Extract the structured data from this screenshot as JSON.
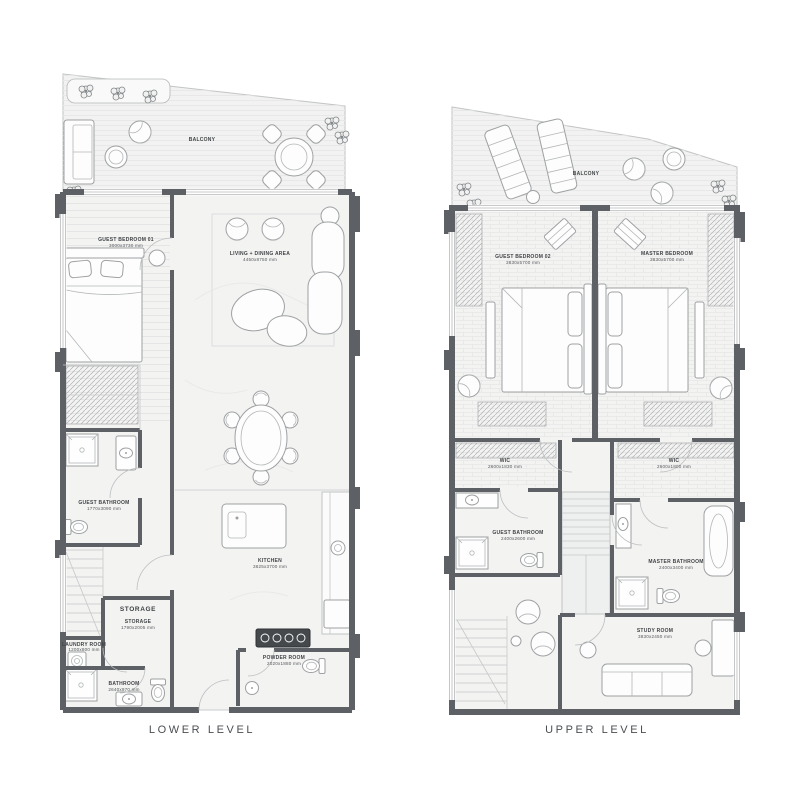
{
  "colors": {
    "wall": "#5d6165",
    "floor": "#f3f3f2",
    "balcony_floor": "#f1f2f1",
    "text": "#404346",
    "background": "#ffffff"
  },
  "lower": {
    "title": "LOWER LEVEL",
    "balcony": "BALCONY",
    "storage_heading": "STORAGE",
    "rooms": {
      "guest_bedroom": {
        "name": "GUEST BEDROOM 01",
        "dims": "3000x3730 mm"
      },
      "living_dining": {
        "name": "LIVING + DINING AREA",
        "dims": "4450x8750 mm"
      },
      "guest_bathroom": {
        "name": "GUEST BATHROOM",
        "dims": "1770x3090 mm"
      },
      "kitchen": {
        "name": "KITCHEN",
        "dims": "3625x3700 mm"
      },
      "storage": {
        "name": "STORAGE",
        "dims": "1790x2005 mm"
      },
      "laundry": {
        "name": "LAUNDRY ROOM",
        "dims": "1200x800 mm"
      },
      "bathroom": {
        "name": "BATHROOM",
        "dims": "2640x970 mm"
      },
      "powder": {
        "name": "POWDER ROOM",
        "dims": "2020x1880 mm"
      }
    }
  },
  "upper": {
    "title": "UPPER LEVEL",
    "balcony": "BALCONY",
    "rooms": {
      "guest_bedroom": {
        "name": "GUEST BEDROOM 02",
        "dims": "3830x5700 mm"
      },
      "master_bedroom": {
        "name": "MASTER BEDROOM",
        "dims": "3830x5700 mm"
      },
      "wic_left": {
        "name": "WIC",
        "dims": "2600x1830 mm"
      },
      "wic_right": {
        "name": "WIC",
        "dims": "2600x1800 mm"
      },
      "guest_bathroom": {
        "name": "GUEST BATHROOM",
        "dims": "2400x2600 mm"
      },
      "master_bathroom": {
        "name": "MASTER BATHROOM",
        "dims": "2400x3400 mm"
      },
      "study": {
        "name": "STUDY ROOM",
        "dims": "3830x2450 mm"
      }
    }
  }
}
